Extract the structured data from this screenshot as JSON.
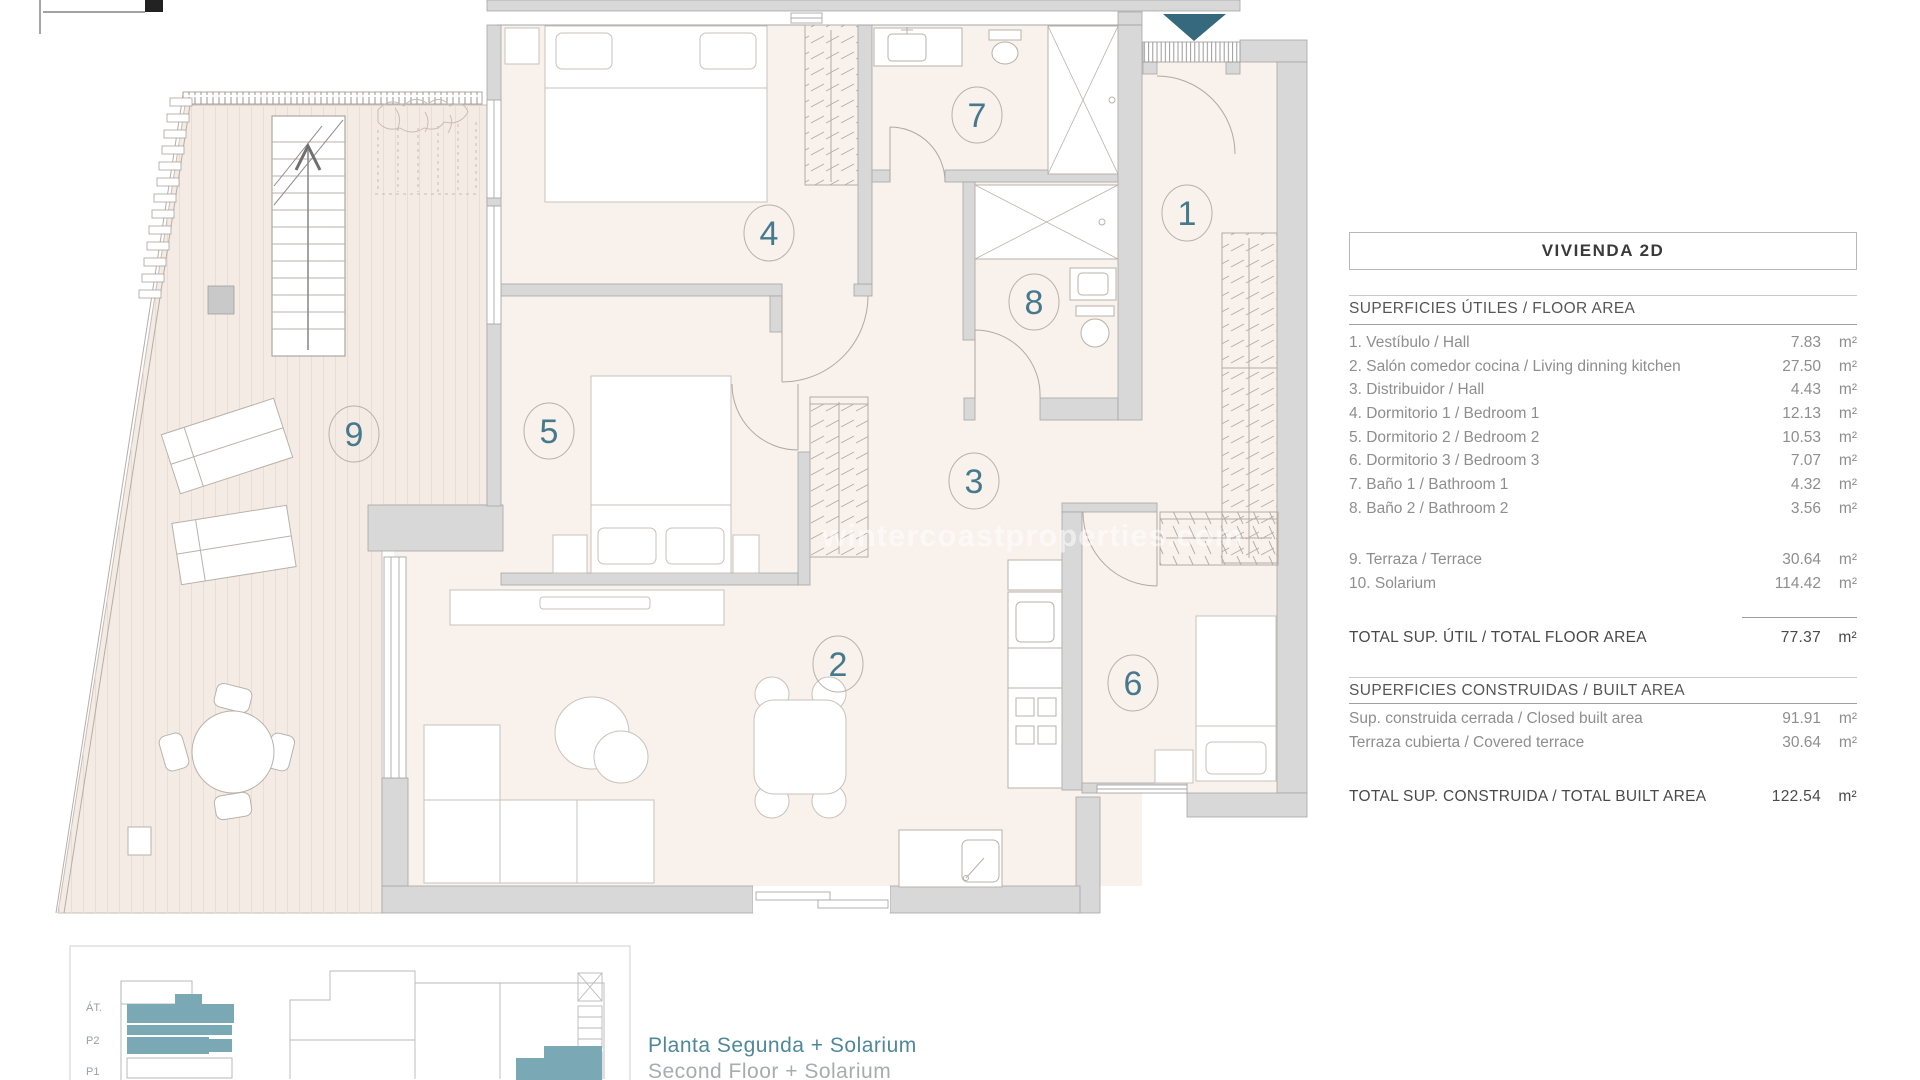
{
  "watermark": "wintercoastproperties.com",
  "plan": {
    "rooms": [
      {
        "number": "1"
      },
      {
        "number": "2"
      },
      {
        "number": "3"
      },
      {
        "number": "4"
      },
      {
        "number": "5"
      },
      {
        "number": "6"
      },
      {
        "number": "7"
      },
      {
        "number": "8"
      },
      {
        "number": "9"
      }
    ]
  },
  "panel": {
    "title": "VIVIENDA 2D",
    "floor_area": {
      "header": "SUPERFICIES ÚTILES / FLOOR AREA",
      "rows": [
        {
          "label": "1. Vestíbulo / Hall",
          "value": "7.83",
          "unit": "m²"
        },
        {
          "label": "2. Salón comedor cocina / Living dinning kitchen",
          "value": "27.50",
          "unit": "m²"
        },
        {
          "label": "3. Distribuidor / Hall",
          "value": "4.43",
          "unit": "m²"
        },
        {
          "label": "4. Dormitorio 1 / Bedroom 1",
          "value": "12.13",
          "unit": "m²"
        },
        {
          "label": "5. Dormitorio 2 / Bedroom 2",
          "value": "10.53",
          "unit": "m²"
        },
        {
          "label": "6. Dormitorio 3 / Bedroom 3",
          "value": "7.07",
          "unit": "m²"
        },
        {
          "label": "7. Baño 1 / Bathroom 1",
          "value": "4.32",
          "unit": "m²"
        },
        {
          "label": "8. Baño 2 / Bathroom 2",
          "value": "3.56",
          "unit": "m²"
        }
      ],
      "extra_rows": [
        {
          "label": "9. Terraza / Terrace",
          "value": "30.64",
          "unit": "m²"
        },
        {
          "label": "10. Solarium",
          "value": "114.42",
          "unit": "m²"
        }
      ],
      "total_label": "TOTAL SUP. ÚTIL / TOTAL FLOOR AREA",
      "total_value": "77.37",
      "total_unit": "m²"
    },
    "built_area": {
      "header": "SUPERFICIES CONSTRUIDAS / BUILT AREA",
      "rows": [
        {
          "label": "Sup. construida cerrada / Closed built area",
          "value": "91.91",
          "unit": "m²"
        },
        {
          "label": "Terraza cubierta / Covered terrace",
          "value": "30.64",
          "unit": "m²"
        }
      ],
      "total_label": "TOTAL SUP. CONSTRUIDA /  TOTAL BUILT AREA",
      "total_value": "122.54",
      "total_unit": "m²"
    }
  },
  "key_diagram": {
    "floor_labels": [
      "ÁT.",
      "P2",
      "P1"
    ],
    "caption_primary": "Planta Segunda + Solarium",
    "caption_secondary": "Second Floor + Solarium"
  },
  "colors": {
    "accent_teal": "#36697e",
    "room_number_teal": "#47798c",
    "caption_teal": "#4e8899",
    "diagram_teal": "#7ba8b5",
    "wall_gray": "#d8d8d8",
    "floor_tint": "#f8f1ec",
    "terrace_tint": "#f4ebe5"
  }
}
